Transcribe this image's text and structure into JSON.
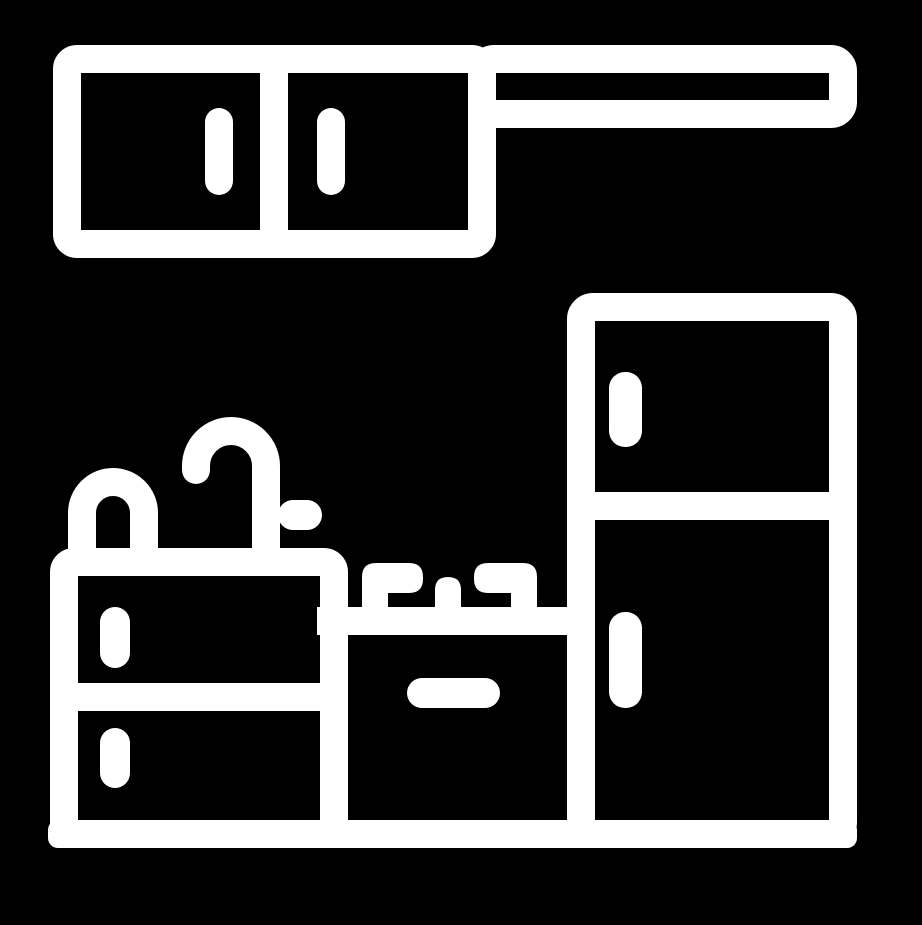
{
  "icon": {
    "name": "kitchen-furniture-pictogram",
    "style": "thick white outline glyph on solid black background",
    "background_color": "#000000",
    "foreground_color": "#ffffff",
    "components": {
      "wall_cabinet": "two-door wall cabinet with vertical pill handles",
      "range_hood_bar": "hollow horizontal bar extending right from wall cabinet top",
      "refrigerator": "two-door refrigerator, freezer on top, vertical pill handles on left edge",
      "sink_unit": "cabinet with two drawers, arched tap and curved faucet with side lever on counter",
      "stove": "oven with horizontal pill handle, cooktop band with two burner brackets and center nub",
      "base_plinth": "continuous base bar under all units"
    }
  }
}
